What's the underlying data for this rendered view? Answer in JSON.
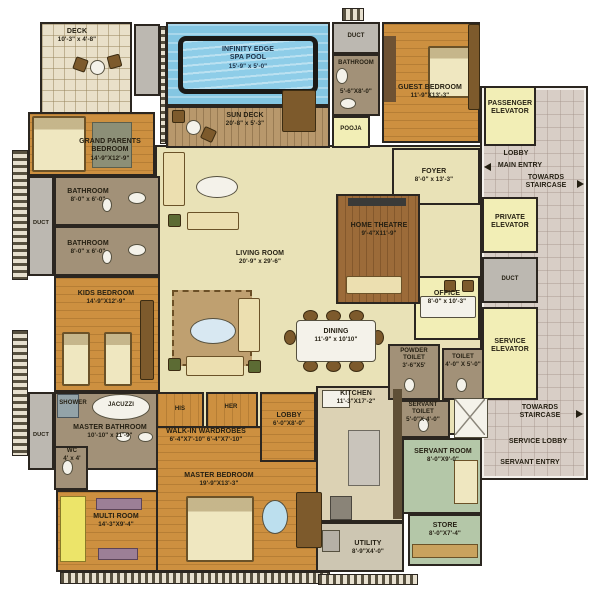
{
  "colors": {
    "wood": "#cd9040",
    "marble": "#e9e2b7",
    "elevator_yellow": "#f2eeb6",
    "pool_blue": "#84c6e2",
    "lobby_tile": "#d8cec6",
    "servant_green": "#b4c7a8",
    "bath_taupe": "#a29178",
    "duct_gray": "#bcb8b1",
    "wall": "#2b2620"
  },
  "rooms": {
    "deck": {
      "label": "DECK",
      "dims": "10'-3\" x 4'-8\""
    },
    "spa_pool": {
      "label": "INFINITY EDGE",
      "label2": "SPA  POOL",
      "dims": "15'-9\" x 5'-0\""
    },
    "sun_deck": {
      "label": "SUN DECK",
      "dims": "20'-8\" x 5'-3\""
    },
    "duct_top": {
      "label": "DUCT"
    },
    "bathroom_guest": {
      "label": "BATHROOM",
      "dims": "5'-6\"X8'-0\""
    },
    "pooja": {
      "label": "POOJA"
    },
    "guest_bedroom": {
      "label": "GUEST BEDROOM",
      "dims": "11'-9\"X13'-3\""
    },
    "passenger_elevator": {
      "label": "PASSENGER ELEVATOR"
    },
    "lobby_main": {
      "label": "LOBBY"
    },
    "main_entry": {
      "label": "MAIN ENTRY"
    },
    "towards_staircase_top": {
      "label": "TOWARDS STAIRCASE"
    },
    "foyer": {
      "label": "FOYER",
      "dims": "8'-0\" x 13'-3\""
    },
    "private_elevator": {
      "label": "PRIVATE ELEVATOR"
    },
    "duct_mid": {
      "label": "DUCT"
    },
    "service_elevator": {
      "label": "SERVICE ELEVATOR"
    },
    "office": {
      "label": "OFFICE",
      "dims": "8'-0\" x 10'-3\""
    },
    "home_theatre": {
      "label": "HOME THEATRE",
      "dims": "9'-4\"X11'-9\""
    },
    "living_room": {
      "label": "LIVING ROOM",
      "dims": "20'-9\" x 29'-6\""
    },
    "dining": {
      "label": "DINING",
      "dims": "11'-9\" x 10'10\""
    },
    "grand_parents_bedroom": {
      "label": "GRAND PARENTS BEDROOM",
      "dims": "14'-9\"X12'-9\""
    },
    "duct_left": {
      "label": "DUCT"
    },
    "bathroom_1": {
      "label": "BATHROOM",
      "dims": "8'-0\" x 6'-0\""
    },
    "bathroom_2": {
      "label": "BATHROOM",
      "dims": "8'-0\" x 6'-0\""
    },
    "kids_bedroom": {
      "label": "KIDS BEDROOM",
      "dims": "14'-9\"X12'-9\""
    },
    "shower": {
      "label": "SHOWER"
    },
    "jacuzzi": {
      "label": "JACUZZI"
    },
    "master_bathroom": {
      "label": "MASTER BATHROOM",
      "dims": "10'-10\" x 11'-9\""
    },
    "wc": {
      "label": "WC",
      "dims": "4' x 4'"
    },
    "duct_bottom": {
      "label": "DUCT"
    },
    "multi_room": {
      "label": "MULTI ROOM",
      "dims": "14'-3\"X9'-4\""
    },
    "his": {
      "label": "HIS"
    },
    "her": {
      "label": "HER"
    },
    "walk_in_wardrobes": {
      "label": "WALK-IN  WARDROBES",
      "dims": "6'-4\"X7'-10\"   6'-4\"X7'-10\""
    },
    "master_bedroom": {
      "label": "MASTER BEDROOM",
      "dims": "19'-9\"X13'-3\""
    },
    "lobby_inner": {
      "label": "LOBBY",
      "dims": "6'-0\"X8'-0\""
    },
    "kitchen": {
      "label": "KITCHEN",
      "dims": "11'-3\"X17'-2\""
    },
    "powder_toilet": {
      "label": "POWDER TOILET",
      "dims": "3'-6\"X5'"
    },
    "toilet": {
      "label": "TOILET",
      "dims": "4'-0\" X 5'-0\""
    },
    "servant_toilet": {
      "label": "SERVANT TOILET",
      "dims": "5'-0\"X 4'-0\""
    },
    "servant_room": {
      "label": "SERVANT ROOM",
      "dims": "8'-0\"X9'-0\""
    },
    "store": {
      "label": "STORE",
      "dims": "8'-0\"X7'-4\""
    },
    "utility": {
      "label": "UTILITY",
      "dims": "8'-9\"X4'-0\""
    },
    "towards_staircase_bottom": {
      "label": "TOWARDS STAIRCASE"
    },
    "service_lobby": {
      "label": "SERVICE LOBBY"
    },
    "servant_entry": {
      "label": "SERVANT ENTRY"
    }
  }
}
